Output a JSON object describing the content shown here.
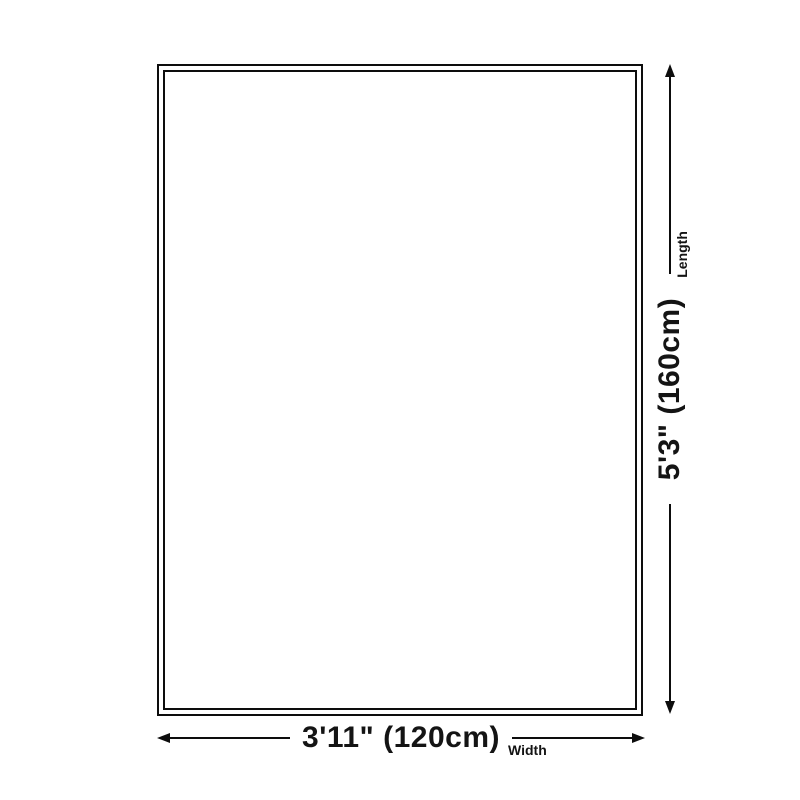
{
  "diagram": {
    "type": "product-size-diagram",
    "width": {
      "value": "3'11\" (120cm)",
      "label": "Width"
    },
    "length": {
      "value": "5'3\" (160cm)",
      "label": "Length"
    }
  },
  "colors": {
    "background": "#ffffff",
    "line": "#0d0d0d",
    "text": "#141414"
  }
}
